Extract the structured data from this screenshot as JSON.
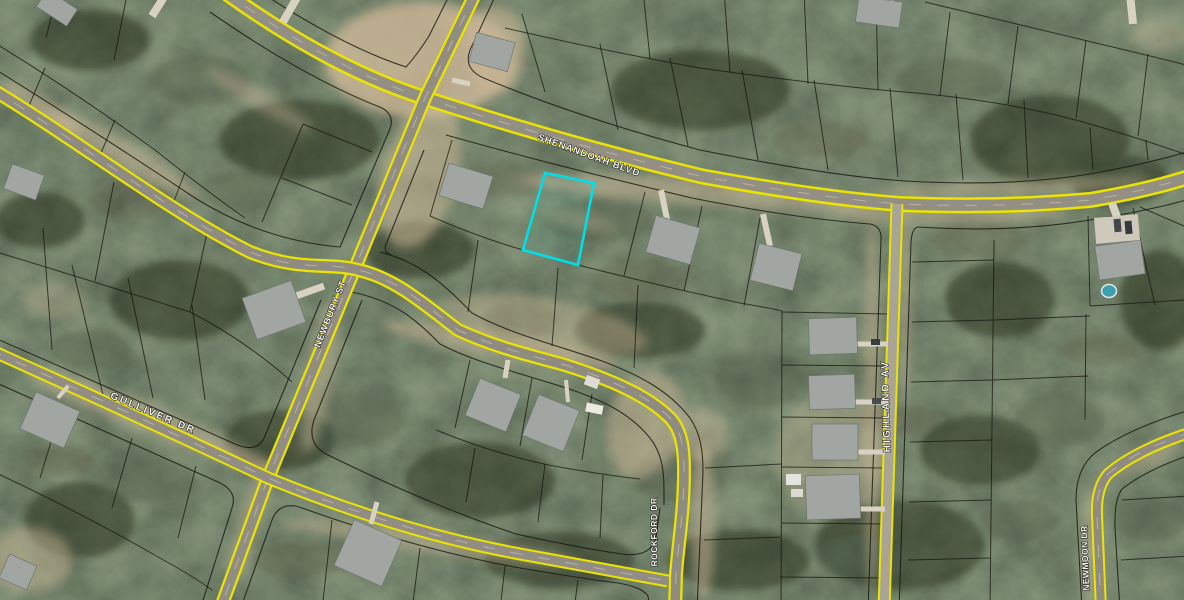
{
  "map": {
    "title": "Aerial parcel map with highlighted lot",
    "streets": [
      {
        "label": "SHENANDOAH BLVD"
      },
      {
        "label": "NEWBURY ST"
      },
      {
        "label": "GULLIVER DR"
      },
      {
        "label": "HIGHLAND AV"
      },
      {
        "label": "ROCKFORD DR"
      },
      {
        "label": "NEWMOON DR"
      }
    ],
    "highlighted_parcel": {
      "outline_color": "#00dfe8",
      "shape": "rectangle"
    },
    "palette": {
      "forest": "#2b3429",
      "sand": "#cdb897",
      "road_edge_yellow": "#eae400",
      "road_surface": "#948f83",
      "parcel_line": "#15150d",
      "label_color": "#f4f4f2"
    }
  }
}
